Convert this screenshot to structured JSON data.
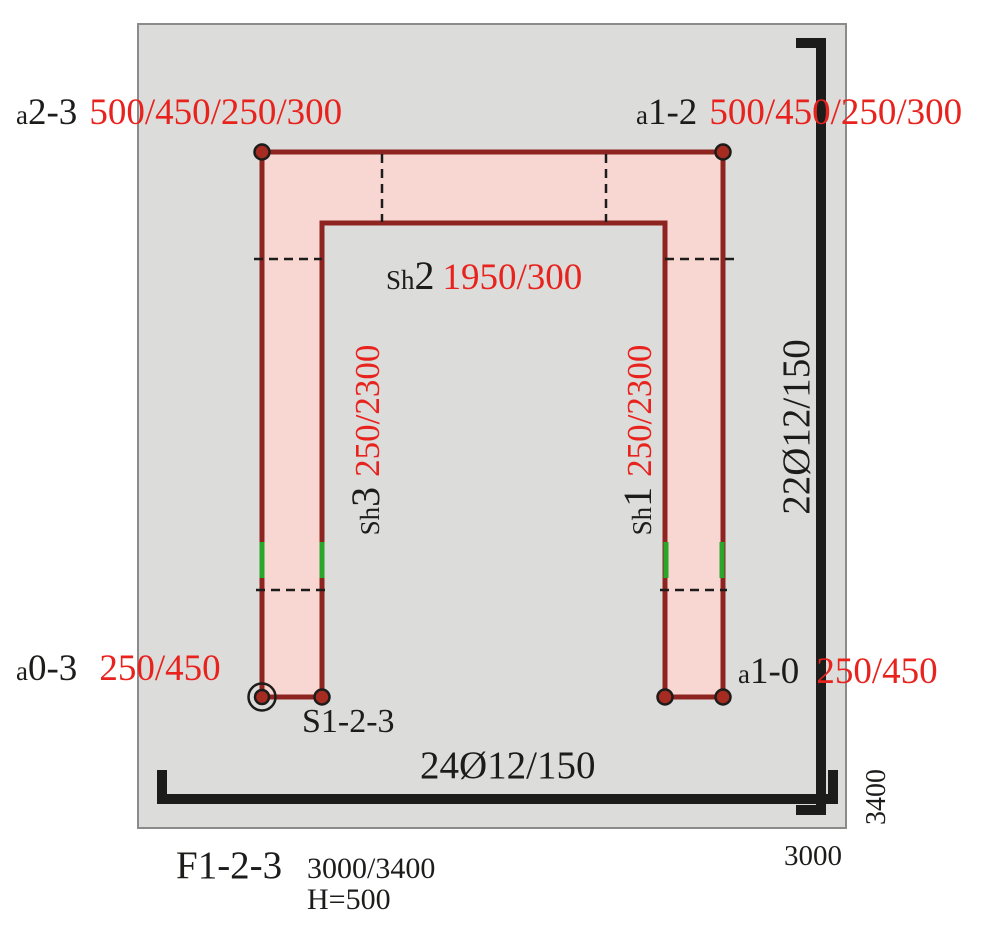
{
  "colors": {
    "slab_fill": "#dcdcda",
    "slab_border": "#8b8b8b",
    "wall_fill": "#f8d7d2",
    "wall_stroke": "#8e2420",
    "node_fill": "#a62b21",
    "dim_red": "#e8221d",
    "ink": "#1c1c1a",
    "green_mark": "#2aa62a"
  },
  "anchors": {
    "top_left": {
      "prefix": "a",
      "id": "2-3",
      "dims": "500/450/250/300"
    },
    "top_right": {
      "prefix": "a",
      "id": "1-2",
      "dims": "500/450/250/300"
    },
    "bottom_left": {
      "prefix": "a",
      "id": "0-3",
      "dims": "250/450"
    },
    "bottom_right": {
      "prefix": "a",
      "id": "1-0",
      "dims": "250/450"
    }
  },
  "shear_walls": {
    "sh2": {
      "prefix": "Sh",
      "id": "2",
      "dims": "1950/300"
    },
    "sh3": {
      "prefix": "Sh",
      "id": "3",
      "dims": "250/2300"
    },
    "sh1": {
      "prefix": "Sh",
      "id": "1",
      "dims": "250/2300"
    }
  },
  "wall_group_label": "S1-2-3",
  "reinforcement": {
    "bottom": "24Ø12/150",
    "right": "22Ø12/150"
  },
  "dimensions": {
    "width": "3000",
    "height": "3400"
  },
  "footing": {
    "name": "F1-2-3",
    "plan_dims": "3000/3400",
    "height": "H=500"
  }
}
